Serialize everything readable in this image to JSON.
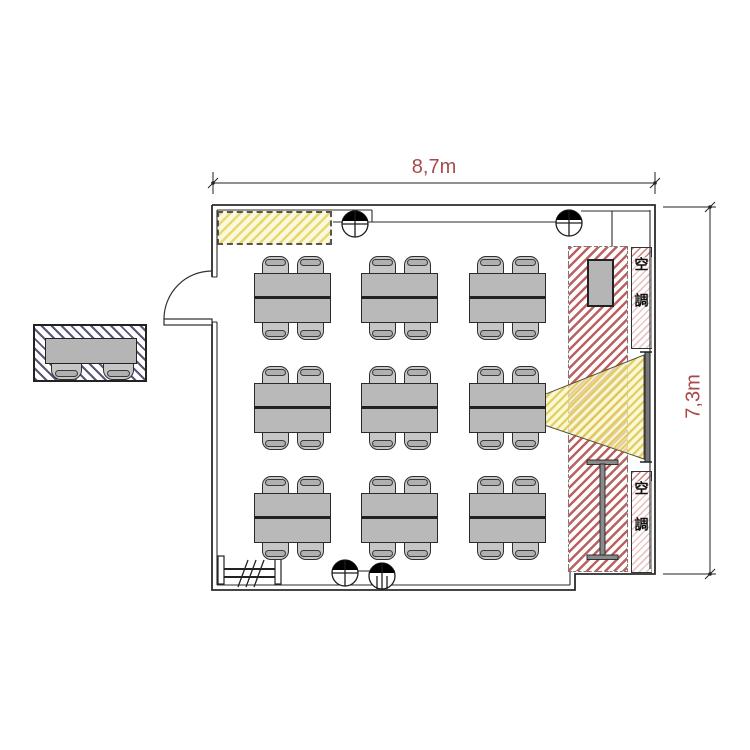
{
  "dimensions": {
    "width_label": "8,7m",
    "height_label": "7,3m",
    "label_color": "#a94a4a"
  },
  "ac_units": [
    {
      "label": "空調"
    },
    {
      "label": "空調"
    }
  ],
  "colors": {
    "wall_line": "#2b2b2b",
    "table_fill": "#b9b9b9",
    "whiteboard_hatch": "#e8d96e",
    "av_zone_hatch": "#bb6161",
    "ac_box_hatch": "#cc8080",
    "outside_zone_hatch": "#565678",
    "beam_fill": "#f3ecaf",
    "dimension_text": "#a94a4a"
  },
  "furniture": {
    "table_grid": {
      "col_x": [
        254,
        361,
        469
      ],
      "row_y": [
        273,
        383,
        493
      ],
      "table_w": 77,
      "table_h": 50,
      "chair_w": 27,
      "chair_h": 21,
      "chair_offsets_x": [
        8,
        43
      ]
    },
    "outside_tables": 1
  }
}
